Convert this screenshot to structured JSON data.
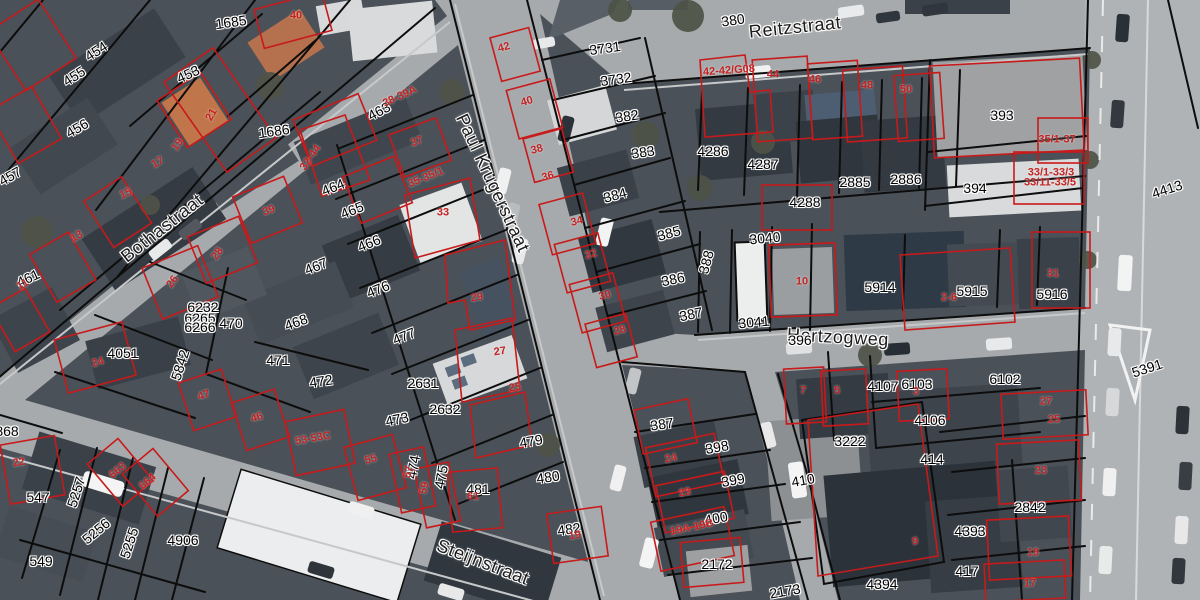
{
  "map": {
    "colors": {
      "parcel_line": "#111111",
      "house_line": "#c81f1f",
      "street_label": "#1b1b1b",
      "parcel_label": "#000000",
      "house_label": "#c32222",
      "street_fill": "#a7aaac",
      "block_fill": "#4a5158"
    },
    "streets": [
      {
        "text": "Reitzstraat",
        "x": 795,
        "y": 27,
        "rot": -6
      },
      {
        "text": "Paul Krugerstraat",
        "x": 493,
        "y": 183,
        "rot": 65
      },
      {
        "text": "Bothastraat",
        "x": 162,
        "y": 228,
        "rot": -38
      },
      {
        "text": "Hertzogweg",
        "x": 838,
        "y": 337,
        "rot": 3
      },
      {
        "text": "Steijnstraat",
        "x": 483,
        "y": 562,
        "rot": 21
      }
    ],
    "parcel_labels": [
      {
        "text": "1685",
        "x": 231,
        "y": 22,
        "rot": -8
      },
      {
        "text": "454",
        "x": 96,
        "y": 51,
        "rot": -33
      },
      {
        "text": "455",
        "x": 74,
        "y": 76,
        "rot": -33
      },
      {
        "text": "453",
        "x": 188,
        "y": 74,
        "rot": -25
      },
      {
        "text": "456",
        "x": 77,
        "y": 128,
        "rot": -30
      },
      {
        "text": "457",
        "x": 10,
        "y": 176,
        "rot": -30
      },
      {
        "text": "1686",
        "x": 274,
        "y": 131,
        "rot": -8
      },
      {
        "text": "461",
        "x": 28,
        "y": 278,
        "rot": -25
      },
      {
        "text": "463",
        "x": 379,
        "y": 111,
        "rot": -28
      },
      {
        "text": "464",
        "x": 333,
        "y": 187,
        "rot": -22
      },
      {
        "text": "465",
        "x": 352,
        "y": 210,
        "rot": -22
      },
      {
        "text": "466",
        "x": 369,
        "y": 243,
        "rot": -22
      },
      {
        "text": "467",
        "x": 316,
        "y": 266,
        "rot": -22
      },
      {
        "text": "476",
        "x": 378,
        "y": 289,
        "rot": -22
      },
      {
        "text": "477",
        "x": 404,
        "y": 336,
        "rot": -22
      },
      {
        "text": "468",
        "x": 296,
        "y": 322,
        "rot": -20
      },
      {
        "text": "6232",
        "x": 203,
        "y": 307,
        "rot": 0
      },
      {
        "text": "6265",
        "x": 200,
        "y": 318,
        "rot": 0
      },
      {
        "text": "6266",
        "x": 200,
        "y": 327,
        "rot": 0
      },
      {
        "text": "470",
        "x": 231,
        "y": 323,
        "rot": 0
      },
      {
        "text": "4051",
        "x": 123,
        "y": 353,
        "rot": 0
      },
      {
        "text": "471",
        "x": 278,
        "y": 360,
        "rot": 0
      },
      {
        "text": "472",
        "x": 321,
        "y": 381,
        "rot": -8
      },
      {
        "text": "2631",
        "x": 423,
        "y": 383,
        "rot": 0
      },
      {
        "text": "2632",
        "x": 445,
        "y": 409,
        "rot": 0
      },
      {
        "text": "473",
        "x": 397,
        "y": 419,
        "rot": -12
      },
      {
        "text": "474",
        "x": 413,
        "y": 467,
        "rot": -80
      },
      {
        "text": "475",
        "x": 441,
        "y": 477,
        "rot": -80
      },
      {
        "text": "481",
        "x": 478,
        "y": 489,
        "rot": 0
      },
      {
        "text": "479",
        "x": 531,
        "y": 441,
        "rot": -10
      },
      {
        "text": "480",
        "x": 548,
        "y": 477,
        "rot": -8
      },
      {
        "text": "482",
        "x": 569,
        "y": 529,
        "rot": -8
      },
      {
        "text": "5842",
        "x": 180,
        "y": 365,
        "rot": -72
      },
      {
        "text": "5257",
        "x": 76,
        "y": 492,
        "rot": -72
      },
      {
        "text": "5256",
        "x": 96,
        "y": 531,
        "rot": -40
      },
      {
        "text": "5255",
        "x": 129,
        "y": 543,
        "rot": -72
      },
      {
        "text": "547",
        "x": 38,
        "y": 497,
        "rot": 0
      },
      {
        "text": "549",
        "x": 41,
        "y": 561,
        "rot": 0
      },
      {
        "text": "868",
        "x": 7,
        "y": 431,
        "rot": 0
      },
      {
        "text": "4906",
        "x": 183,
        "y": 540,
        "rot": 0
      },
      {
        "text": "3731",
        "x": 605,
        "y": 48,
        "rot": -8
      },
      {
        "text": "3732",
        "x": 616,
        "y": 79,
        "rot": -8
      },
      {
        "text": "382",
        "x": 627,
        "y": 116,
        "rot": -8
      },
      {
        "text": "383",
        "x": 643,
        "y": 152,
        "rot": -8
      },
      {
        "text": "384",
        "x": 615,
        "y": 195,
        "rot": -15
      },
      {
        "text": "385",
        "x": 669,
        "y": 233,
        "rot": -15
      },
      {
        "text": "386",
        "x": 673,
        "y": 279,
        "rot": -12
      },
      {
        "text": "387",
        "x": 691,
        "y": 314,
        "rot": -12
      },
      {
        "text": "388",
        "x": 706,
        "y": 262,
        "rot": -75
      },
      {
        "text": "380",
        "x": 733,
        "y": 20,
        "rot": -8
      },
      {
        "text": "4286",
        "x": 713,
        "y": 151,
        "rot": 0
      },
      {
        "text": "4287",
        "x": 763,
        "y": 164,
        "rot": 0
      },
      {
        "text": "2885",
        "x": 855,
        "y": 182,
        "rot": 0
      },
      {
        "text": "2886",
        "x": 906,
        "y": 179,
        "rot": 0
      },
      {
        "text": "4288",
        "x": 805,
        "y": 202,
        "rot": 0
      },
      {
        "text": "393",
        "x": 1002,
        "y": 115,
        "rot": 0
      },
      {
        "text": "394",
        "x": 975,
        "y": 188,
        "rot": 0
      },
      {
        "text": "4413",
        "x": 1167,
        "y": 189,
        "rot": -18
      },
      {
        "text": "3040",
        "x": 765,
        "y": 238,
        "rot": -5
      },
      {
        "text": "3041",
        "x": 754,
        "y": 322,
        "rot": -5
      },
      {
        "text": "5914",
        "x": 880,
        "y": 287,
        "rot": 0
      },
      {
        "text": "5915",
        "x": 972,
        "y": 291,
        "rot": 0
      },
      {
        "text": "5916",
        "x": 1052,
        "y": 294,
        "rot": 0
      },
      {
        "text": "396",
        "x": 800,
        "y": 340,
        "rot": 0
      },
      {
        "text": "4107",
        "x": 883,
        "y": 386,
        "rot": 0
      },
      {
        "text": "6103",
        "x": 917,
        "y": 384,
        "rot": 0
      },
      {
        "text": "6102",
        "x": 1005,
        "y": 379,
        "rot": 0
      },
      {
        "text": "4106",
        "x": 930,
        "y": 420,
        "rot": 0
      },
      {
        "text": "3222",
        "x": 850,
        "y": 441,
        "rot": 0
      },
      {
        "text": "414",
        "x": 932,
        "y": 459,
        "rot": 0
      },
      {
        "text": "410",
        "x": 803,
        "y": 480,
        "rot": -10
      },
      {
        "text": "387",
        "x": 662,
        "y": 424,
        "rot": -8
      },
      {
        "text": "398",
        "x": 717,
        "y": 447,
        "rot": -10
      },
      {
        "text": "399",
        "x": 733,
        "y": 480,
        "rot": -10
      },
      {
        "text": "400",
        "x": 716,
        "y": 518,
        "rot": -10
      },
      {
        "text": "2172",
        "x": 717,
        "y": 564,
        "rot": 0
      },
      {
        "text": "2173",
        "x": 785,
        "y": 591,
        "rot": -10
      },
      {
        "text": "4394",
        "x": 882,
        "y": 584,
        "rot": 0
      },
      {
        "text": "4393",
        "x": 970,
        "y": 531,
        "rot": 0
      },
      {
        "text": "2842",
        "x": 1030,
        "y": 507,
        "rot": 0
      },
      {
        "text": "417",
        "x": 967,
        "y": 571,
        "rot": 0
      },
      {
        "text": "5391",
        "x": 1147,
        "y": 368,
        "rot": -18
      }
    ],
    "house_numbers": [
      {
        "text": "40",
        "x": 296,
        "y": 16,
        "rot": 0
      },
      {
        "text": "21",
        "x": 212,
        "y": 115,
        "rot": -60
      },
      {
        "text": "19",
        "x": 178,
        "y": 145,
        "rot": -55
      },
      {
        "text": "17",
        "x": 158,
        "y": 163,
        "rot": -30
      },
      {
        "text": "15",
        "x": 126,
        "y": 194,
        "rot": -25
      },
      {
        "text": "13",
        "x": 77,
        "y": 237,
        "rot": -30
      },
      {
        "text": "11",
        "x": 23,
        "y": 285,
        "rot": -30
      },
      {
        "text": "39",
        "x": 269,
        "y": 211,
        "rot": -20
      },
      {
        "text": "28",
        "x": 218,
        "y": 254,
        "rot": -55
      },
      {
        "text": "26",
        "x": 173,
        "y": 282,
        "rot": -55
      },
      {
        "text": "24",
        "x": 98,
        "y": 363,
        "rot": -15
      },
      {
        "text": "22",
        "x": 19,
        "y": 463,
        "rot": -10
      },
      {
        "text": "47",
        "x": 204,
        "y": 396,
        "rot": -18
      },
      {
        "text": "46",
        "x": 257,
        "y": 418,
        "rot": -18
      },
      {
        "text": "663",
        "x": 118,
        "y": 471,
        "rot": -40
      },
      {
        "text": "664",
        "x": 148,
        "y": 482,
        "rot": -40
      },
      {
        "text": "38-39A",
        "x": 400,
        "y": 97,
        "rot": -25
      },
      {
        "text": "32-44",
        "x": 311,
        "y": 158,
        "rot": -55
      },
      {
        "text": "37",
        "x": 417,
        "y": 142,
        "rot": -20
      },
      {
        "text": "35-35/1",
        "x": 426,
        "y": 178,
        "rot": -22
      },
      {
        "text": "33",
        "x": 443,
        "y": 213,
        "rot": 0
      },
      {
        "text": "29",
        "x": 477,
        "y": 298,
        "rot": -8
      },
      {
        "text": "27",
        "x": 500,
        "y": 352,
        "rot": -8
      },
      {
        "text": "25",
        "x": 515,
        "y": 388,
        "rot": -8
      },
      {
        "text": "42",
        "x": 504,
        "y": 48,
        "rot": -15
      },
      {
        "text": "40",
        "x": 527,
        "y": 102,
        "rot": -15
      },
      {
        "text": "38",
        "x": 537,
        "y": 150,
        "rot": -15
      },
      {
        "text": "36",
        "x": 548,
        "y": 177,
        "rot": -15
      },
      {
        "text": "34",
        "x": 577,
        "y": 222,
        "rot": -15
      },
      {
        "text": "32",
        "x": 591,
        "y": 255,
        "rot": -15
      },
      {
        "text": "30",
        "x": 605,
        "y": 296,
        "rot": -15
      },
      {
        "text": "28",
        "x": 620,
        "y": 331,
        "rot": -15
      },
      {
        "text": "42-42/G08",
        "x": 729,
        "y": 71,
        "rot": -4
      },
      {
        "text": "44",
        "x": 773,
        "y": 75,
        "rot": 0
      },
      {
        "text": "46",
        "x": 815,
        "y": 80,
        "rot": 0
      },
      {
        "text": "48",
        "x": 867,
        "y": 86,
        "rot": 0
      },
      {
        "text": "50",
        "x": 906,
        "y": 90,
        "rot": 0
      },
      {
        "text": "35/1-37",
        "x": 1057,
        "y": 140,
        "rot": 0
      },
      {
        "text": "33/1-33/3",
        "x": 1051,
        "y": 173,
        "rot": 0
      },
      {
        "text": "33/11-33/5",
        "x": 1050,
        "y": 183,
        "rot": 0
      },
      {
        "text": "10",
        "x": 802,
        "y": 282,
        "rot": 0
      },
      {
        "text": "2-6",
        "x": 949,
        "y": 298,
        "rot": 0
      },
      {
        "text": "31",
        "x": 1053,
        "y": 274,
        "rot": 0
      },
      {
        "text": "7",
        "x": 803,
        "y": 391,
        "rot": 0
      },
      {
        "text": "5",
        "x": 837,
        "y": 391,
        "rot": 0
      },
      {
        "text": "3",
        "x": 916,
        "y": 392,
        "rot": 0
      },
      {
        "text": "53-53C",
        "x": 313,
        "y": 439,
        "rot": -10
      },
      {
        "text": "55",
        "x": 371,
        "y": 460,
        "rot": -15
      },
      {
        "text": "57",
        "x": 409,
        "y": 472,
        "rot": -78
      },
      {
        "text": "59",
        "x": 425,
        "y": 488,
        "rot": -78
      },
      {
        "text": "61",
        "x": 473,
        "y": 497,
        "rot": 0
      },
      {
        "text": "19",
        "x": 575,
        "y": 536,
        "rot": -10
      },
      {
        "text": "24",
        "x": 671,
        "y": 459,
        "rot": -12
      },
      {
        "text": "23",
        "x": 685,
        "y": 493,
        "rot": -12
      },
      {
        "text": "19A-19B",
        "x": 692,
        "y": 528,
        "rot": -12
      },
      {
        "text": "9",
        "x": 915,
        "y": 542,
        "rot": 0
      },
      {
        "text": "27",
        "x": 1046,
        "y": 402,
        "rot": 0
      },
      {
        "text": "25",
        "x": 1054,
        "y": 420,
        "rot": 0
      },
      {
        "text": "23",
        "x": 1041,
        "y": 471,
        "rot": 0
      },
      {
        "text": "19",
        "x": 1033,
        "y": 553,
        "rot": 0
      },
      {
        "text": "17",
        "x": 1030,
        "y": 584,
        "rot": 0
      }
    ]
  }
}
